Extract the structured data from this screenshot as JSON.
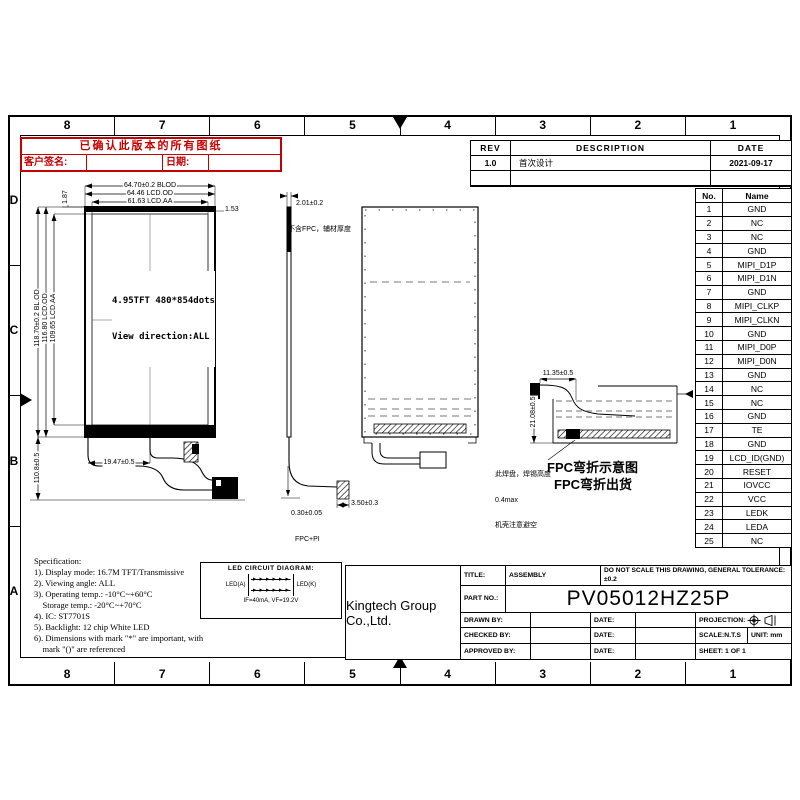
{
  "sheet": {
    "zone_cols": [
      "8",
      "7",
      "6",
      "5",
      "4",
      "3",
      "2",
      "1"
    ],
    "zone_rows": [
      "D",
      "C",
      "B",
      "A"
    ]
  },
  "stamp": {
    "title": "已确认此版本的所有图纸",
    "sign_label": "客户签名:",
    "date_label": "日期:"
  },
  "revision_table": {
    "col_rev": "REV",
    "col_desc": "DESCRIPTION",
    "col_date": "DATE",
    "rev": "1.0",
    "description": "首次设计",
    "date": "2021-09-17"
  },
  "pin_table": {
    "col_no": "No.",
    "col_name": "Name",
    "pins": [
      "GND",
      "NC",
      "NC",
      "GND",
      "MIPI_D1P",
      "MIPI_D1N",
      "GND",
      "MIPI_CLKP",
      "MIPI_CLKN",
      "GND",
      "MIPI_D0P",
      "MIPI_D0N",
      "GND",
      "NC",
      "NC",
      "GND",
      "TE",
      "GND",
      "LCD_ID(GND)",
      "RESET",
      "IOVCC",
      "VCC",
      "LEDK",
      "LEDA",
      "NC"
    ],
    "pin_count": 25
  },
  "front_view": {
    "width_blod": "64.70±0.2 BLOD",
    "width_od": "64.46 LCD.OD",
    "width_aa": "61.63 LCD.AA",
    "height_blod": "118.70±0.2 BL.OD",
    "height_od": "116.80 LCD.OD",
    "height_aa": "109.65 LCD.AA",
    "corner_left": "1.87",
    "corner_right": "1.53",
    "panel_line1": "4.95TFT 480*854dots",
    "panel_line2": "View direction:ALL",
    "fpc_height": "110.8±0.5",
    "fpc_width": "19.47±0.5"
  },
  "side_view": {
    "thickness": "2.01±0.2",
    "thickness_note": "不含FPC，辅材厚度",
    "fpc_thickness": "0.30±0.05",
    "fpc_thickness_note": "FPC+PI",
    "connector_width": "3.50±0.3"
  },
  "folded_view": {
    "fpc_extension": "11.35±0.5",
    "fold_height": "21.08±0.5",
    "pad_note_1": "此焊盘，焊锡高度",
    "pad_note_2": "0.4max",
    "pad_note_3": "机壳注意避空",
    "caption_1": "FPC弯折示意图",
    "caption_2": "FPC弯折出货"
  },
  "led_diagram": {
    "title": "LED CIRCUIT DIAGRAM:",
    "anode": "LED(A)",
    "cathode": "LED(K)",
    "rating": "IF=40mA, VF=19.2V",
    "diodes_per_row": 6,
    "rows": 2
  },
  "specification": {
    "title": "Specification:",
    "lines": [
      "1). Display mode: 16.7M TFT/Transmissive",
      "2). Viewing angle: ALL",
      "3). Operating temp.: -10°C~+60°C",
      "    Storage temp.: -20°C~+70°C",
      "4). IC: ST7701S",
      "5). Backlight: 12 chip White LED",
      "6). Dimensions with mark \"*\" are important, with",
      "    mark \"()\" are referenced"
    ]
  },
  "title_block": {
    "company": "Kingtech Group Co.,Ltd.",
    "title_label": "TITLE:",
    "title_value": "ASSEMBLY",
    "note": "DO NOT SCALE THIS DRAWING, GENERAL TOLERANCE:±0.2",
    "part_label": "PART NO.:",
    "part_value": "PV05012HZ25P",
    "drawn_label": "DRAWN BY:",
    "checked_label": "CHECKED BY:",
    "approved_label": "APPROVED BY:",
    "date_label": "DATE:",
    "projection_label": "PROJECTION:",
    "scale_label": "SCALE:N.T.S",
    "unit_label": "UNIT:  mm",
    "sheet_label": "SHEET:  1  OF  1"
  },
  "colors": {
    "stamp_red": "#c40000",
    "line_black": "#000000",
    "dash_gray": "#777777"
  }
}
